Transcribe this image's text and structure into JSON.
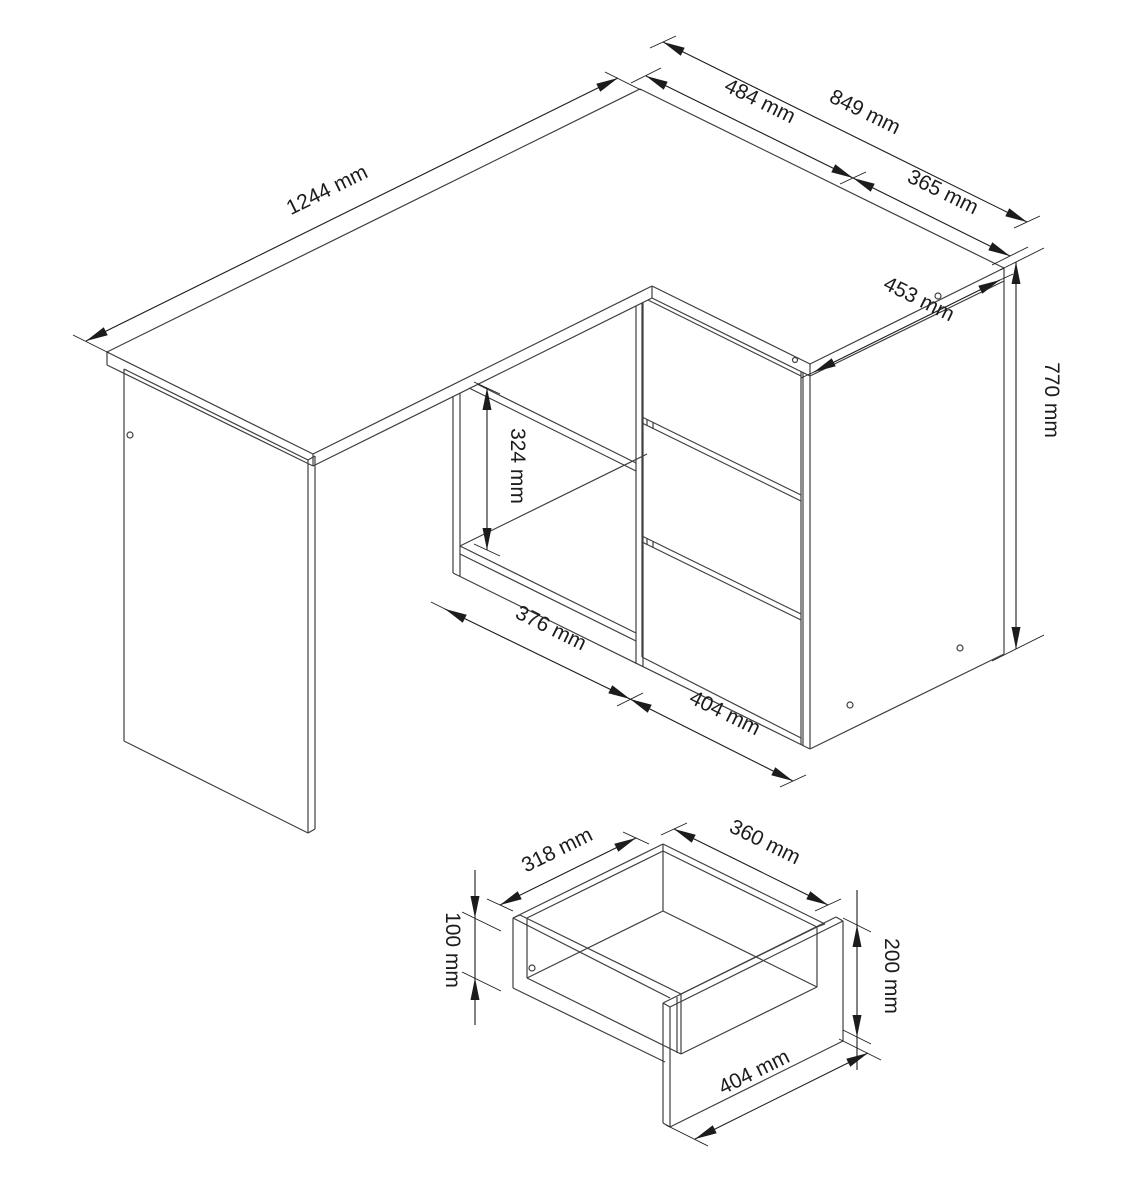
{
  "drawing": {
    "background": "#ffffff",
    "geometry_line_color": "#3f3f3f",
    "dimension_line_color": "#1c1c1c",
    "main_drawing": {
      "dimensions": {
        "desk_length": "1244 mm",
        "top_segment": "484 mm",
        "top_total": "849 mm",
        "top_right": "365 mm",
        "pedestal_depth": "453 mm",
        "height": "770 mm",
        "shelf_opening_height": "324 mm",
        "shelf_opening_width": "376 mm",
        "drawer_width": "404 mm"
      }
    },
    "drawer_detail": {
      "dimensions": {
        "inner_width": "318 mm",
        "inner_depth": "360 mm",
        "inner_height": "100 mm",
        "front_height": "200 mm",
        "front_width": "404 mm"
      }
    }
  }
}
